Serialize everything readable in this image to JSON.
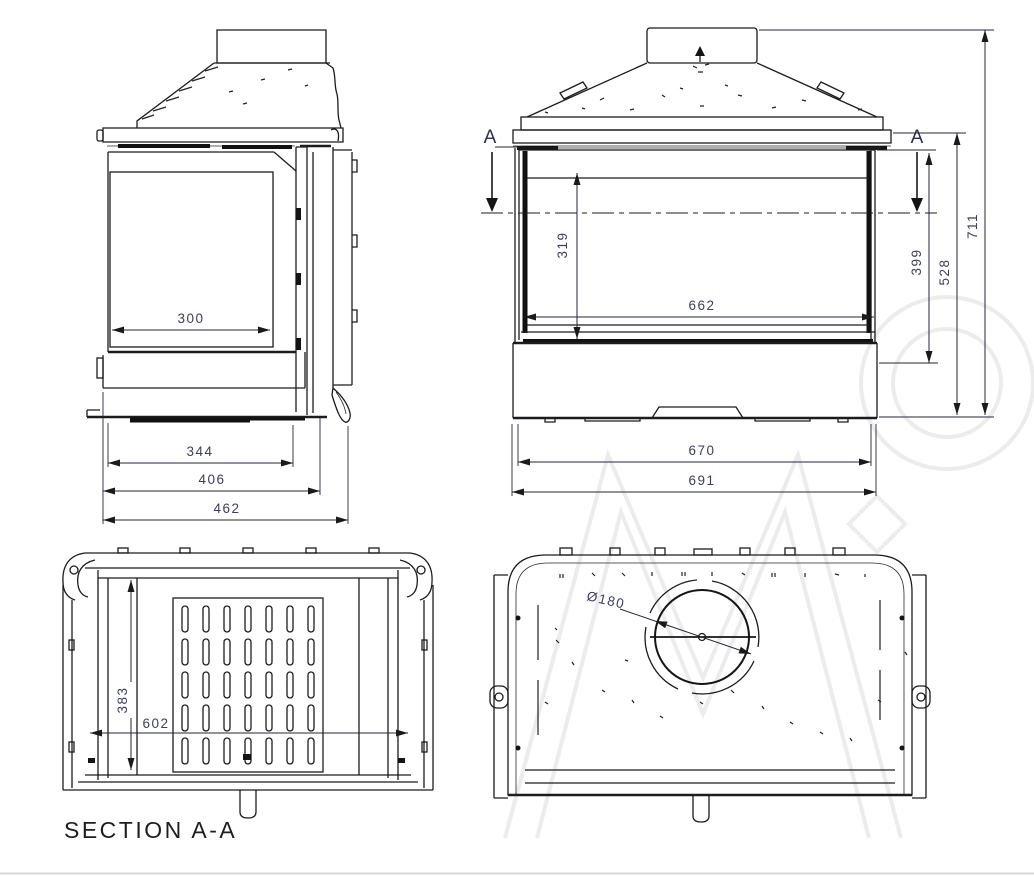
{
  "page": {
    "background": "#ffffff",
    "footer_rule_color": "#d8d8d8"
  },
  "drawing": {
    "kind": "fireplace-insert technical drawing, four orthographic views"
  },
  "views": {
    "side": {
      "name": "side view",
      "dims": {
        "glass_width": "300",
        "base_width": "344",
        "body_depth": "406",
        "total_depth": "462"
      }
    },
    "front": {
      "name": "front view",
      "section_marker": "A",
      "dims": {
        "glass_height": "319",
        "glass_width": "662",
        "axis_height": "399",
        "body_height": "528",
        "total_height": "711",
        "body_width": "670",
        "total_width": "691"
      }
    },
    "section": {
      "name": "section view",
      "label": "SECTION A-A",
      "dims": {
        "inner_depth": "383",
        "inner_width": "602"
      }
    },
    "top": {
      "name": "top view",
      "dims": {
        "flue_diameter": "Ø180"
      }
    }
  },
  "colors": {
    "line": "#1c1c1c",
    "dimension_text": "#3d3d60",
    "watermark": "#ececec"
  }
}
